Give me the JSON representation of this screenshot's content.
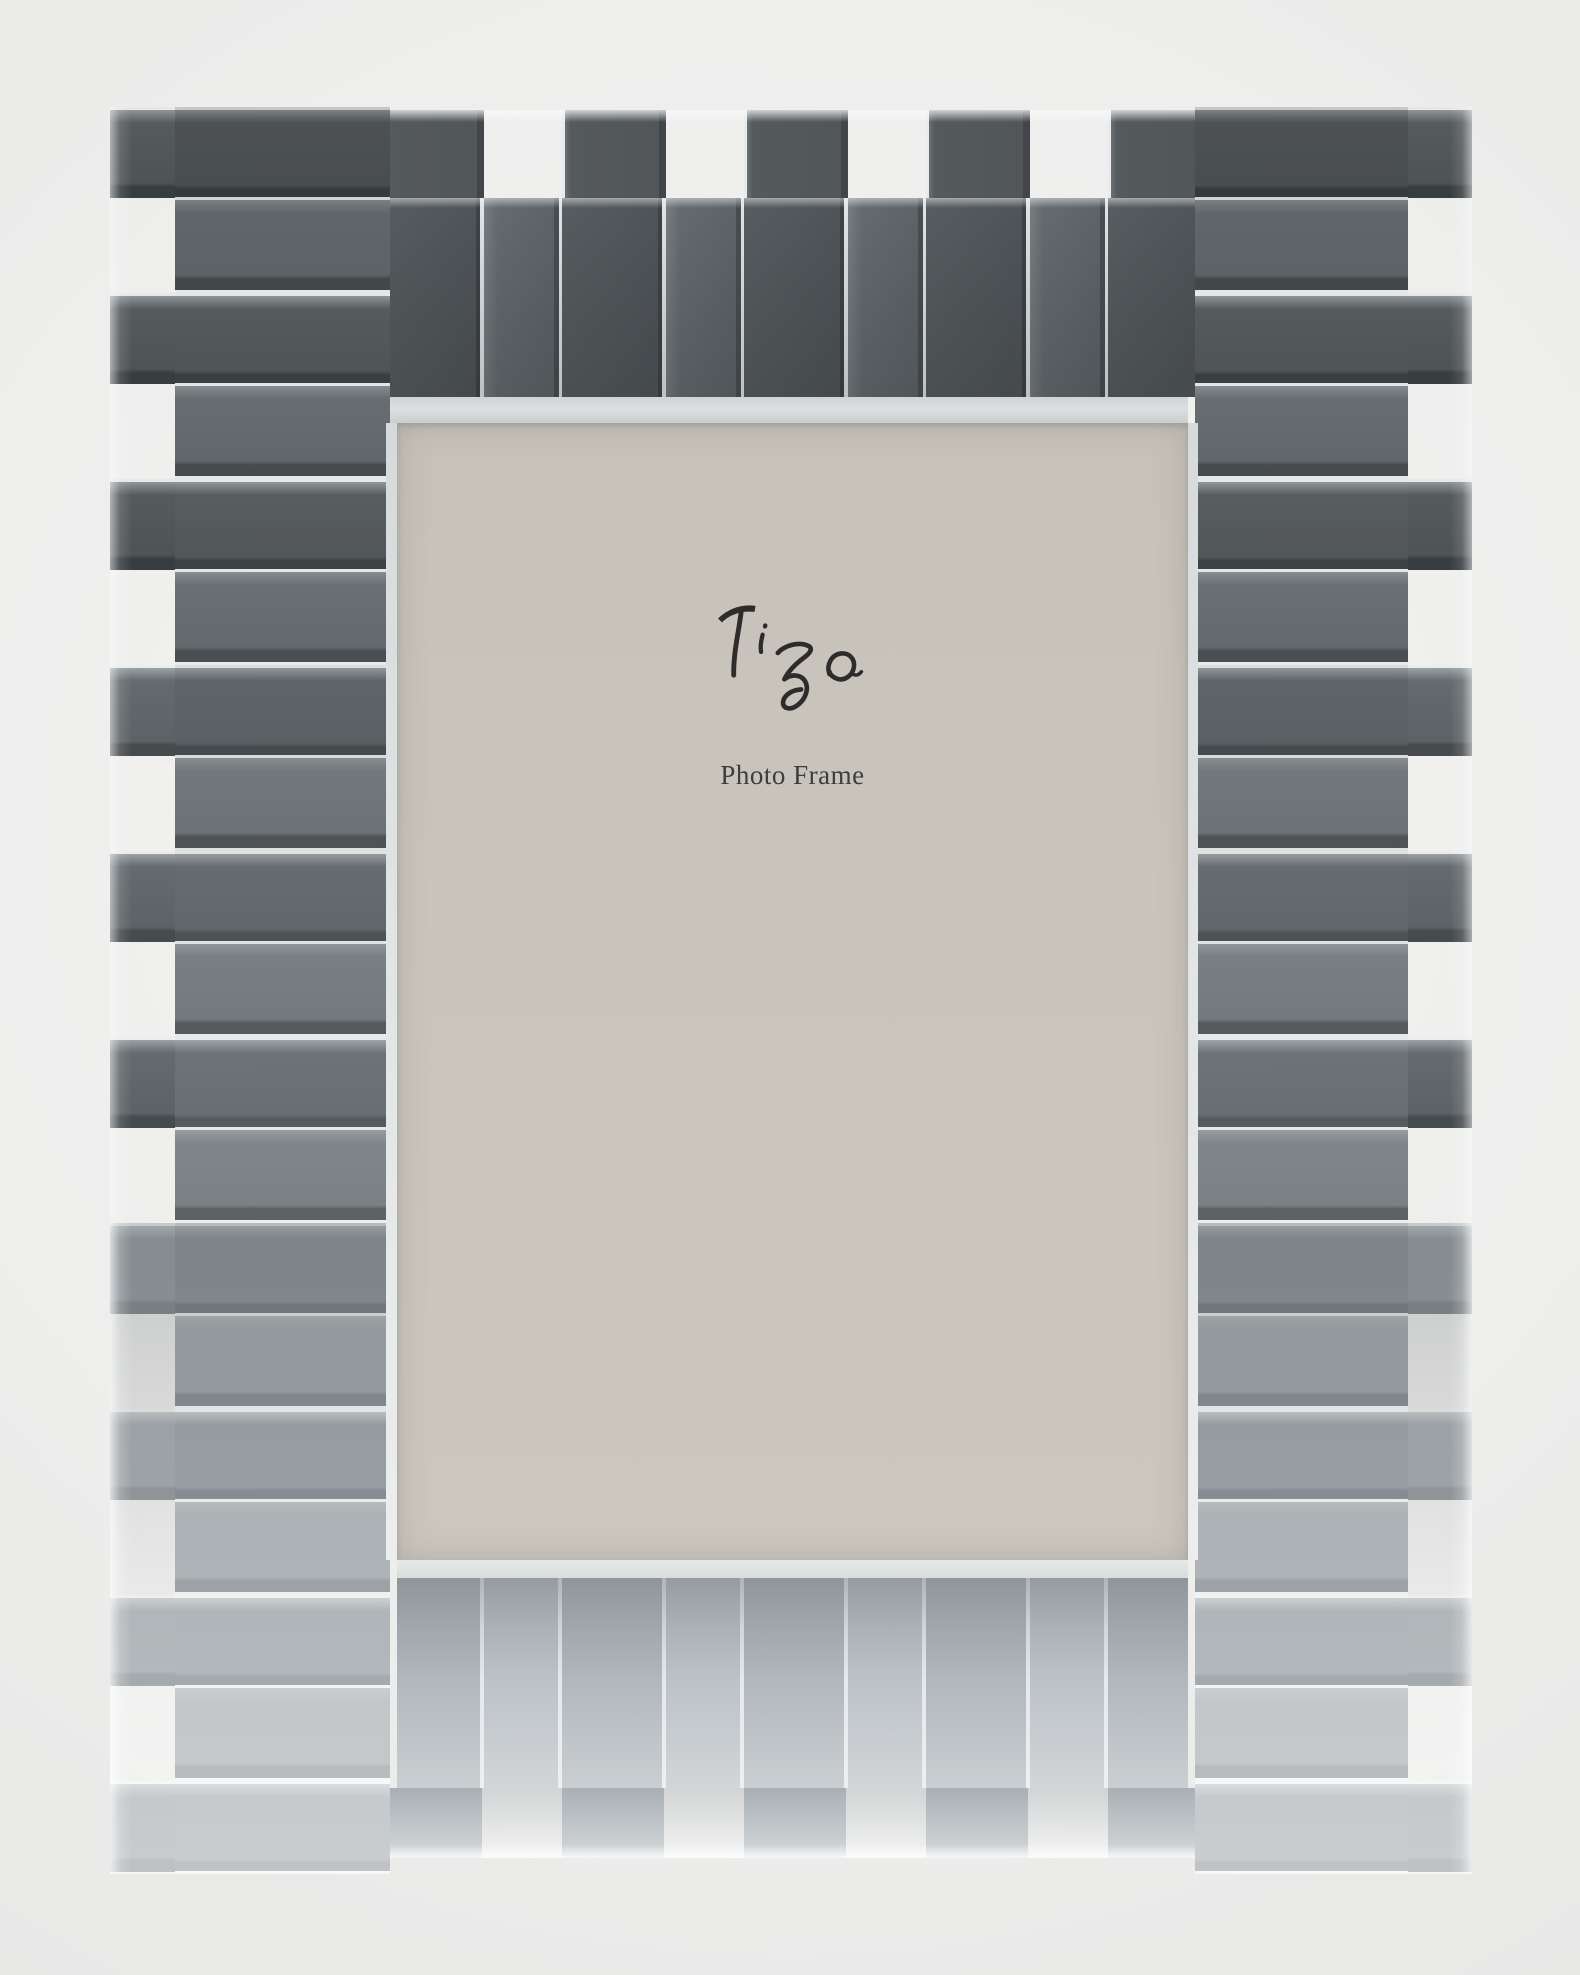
{
  "meta": {
    "type": "product-photo",
    "alt": "Clear crystal photo frame with staggered raised and recessed rectangular blocks around a gray paper insert"
  },
  "insert": {
    "brand_logo": "Tizo",
    "caption": "Photo Frame",
    "paper_color": "#c8c4bc",
    "logo_color": "#2d2c2a",
    "caption_color": "#3e3d3a"
  },
  "frame": {
    "material": "clear crystal blocks",
    "pattern": "alternating protruding and recessed blocks, crenellated edges",
    "colors": {
      "dark_block": "#53585c",
      "mid_block": "#666c70",
      "light_block": "#aab1b5",
      "seam_highlight": "#e8ebeb",
      "background": "#ebebea"
    }
  }
}
